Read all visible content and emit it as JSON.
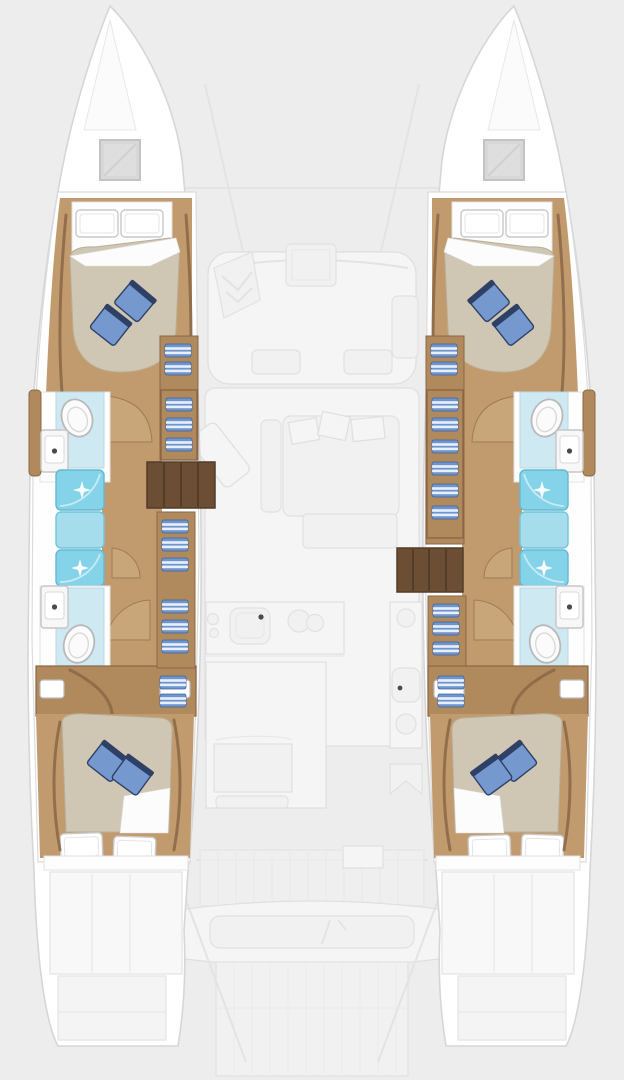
{
  "page": {
    "type": "catamaran-deck-plan",
    "orientation": "bow-up",
    "background": "#ededed"
  },
  "colors": {
    "bg": "#ededed",
    "hullStroke": "#d6d6d6",
    "wood": "#c19b6e",
    "woodMid": "#b08a5c",
    "woodDark": "#8a6747",
    "woodDeep": "#6b4e33",
    "stepStroke": "#523d29",
    "duvet": "#cfc6b3",
    "duvetStroke": "#b9ae97",
    "pillowBlue": "#7598cf",
    "pillowNavy": "#2f4066",
    "showerBright": "#84d3e9",
    "showerMid": "#a5dded",
    "showerPale": "#cfe9f2",
    "linenBlue": "#6f95cd",
    "fanWood": "#c9a87c",
    "fanStroke": "#9a7a52",
    "faintFill": "#f5f5f5",
    "faintStroke": "#e0e0e0"
  },
  "plan": {
    "hulls": [
      "port",
      "starboard"
    ],
    "port_hull_rooms": [
      "forward-cabin",
      "forward-bathroom",
      "shower-stack",
      "aft-bathroom",
      "wardrobe",
      "aft-cabin",
      "swim-platform"
    ],
    "starboard_hull_rooms": [
      "forward-cabin",
      "forward-bathroom",
      "shower-stack",
      "aft-bathroom",
      "wardrobe",
      "aft-cabin",
      "swim-platform"
    ],
    "center_areas": [
      "trampoline",
      "forward-cockpit",
      "saloon",
      "galley",
      "dinette",
      "aft-cockpit",
      "stern-platform"
    ],
    "fixtures": [
      "double-bed",
      "toilet",
      "vanity-sink",
      "shower",
      "galley-sink",
      "stove-burners",
      "companionway-steps",
      "linen-shelves",
      "cockpit-bench",
      "bow-hatch"
    ]
  }
}
